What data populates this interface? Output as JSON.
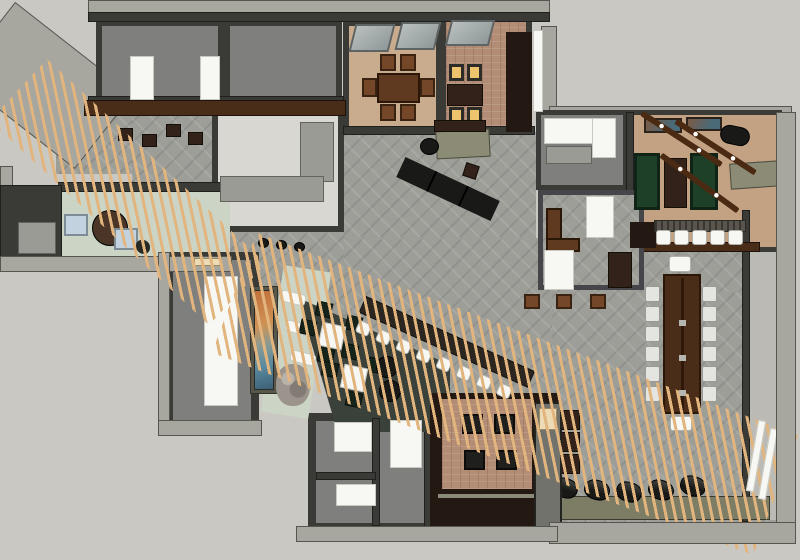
{
  "scene": {
    "kind": "top-down 3D floor plan render",
    "visible_text": "none"
  },
  "palette": {
    "bg": "#c9c8c2",
    "roof": "#a7a69f",
    "roofEdge": "#56564f",
    "wall": "#3a3a36",
    "wallDark": "#1f1f1d",
    "roomGray": "#7f7f7d",
    "roomLight": "#d8d7d2",
    "corridor": "#bbbab4",
    "carpet": "#9e9e99",
    "tan": "#c9ac8d",
    "tan2": "#c3a284",
    "brick": "#b28c74",
    "mint": "#ccd5c5",
    "espresso": "#241812",
    "woodDark": "#4a2d18",
    "wood": "#5f3a20",
    "woodChair": "#744728",
    "woodDarker": "#33221a",
    "beamWood": "#4a2a12",
    "slat": "#e2b57e",
    "white": "#f7f7f4",
    "chairGray": "#e4e4e1",
    "counterGray": "#9b9b95",
    "green": "#1e4028",
    "greenChair": "#16231a",
    "glow": "#eec36d",
    "glowFrame": "#2b2b28",
    "olive": "#7d7d66",
    "olive2": "#8c8c76",
    "oliveWall": "#56564a",
    "lounge": "#3a413b",
    "black": "#191917",
    "blue": "#c2d2de",
    "cream": "#ecdbb4",
    "pillar": "#72726c",
    "rocks": "#9b948c",
    "barband": "#59544c"
  },
  "object_counts": {
    "dining_chairs": 6,
    "glowing_booth_seats": 4,
    "skylights": 3,
    "game_tables": 3,
    "light_beams": 3,
    "wall_pictures": 2,
    "bar_stools_game_room": 5,
    "communal_table_side_chairs": 12,
    "communal_table_end_chairs": 2,
    "diagonal_bar_stools": 8,
    "lounge_white_tables": 2,
    "lounge_green_chairs": 8,
    "lounge_ottomans": 2,
    "den_armchairs": 4,
    "floor_cushions_bottom": 5,
    "blue_chairs_west_room": 2,
    "white_wall_benches": 3,
    "restroom_doorways": 3
  }
}
